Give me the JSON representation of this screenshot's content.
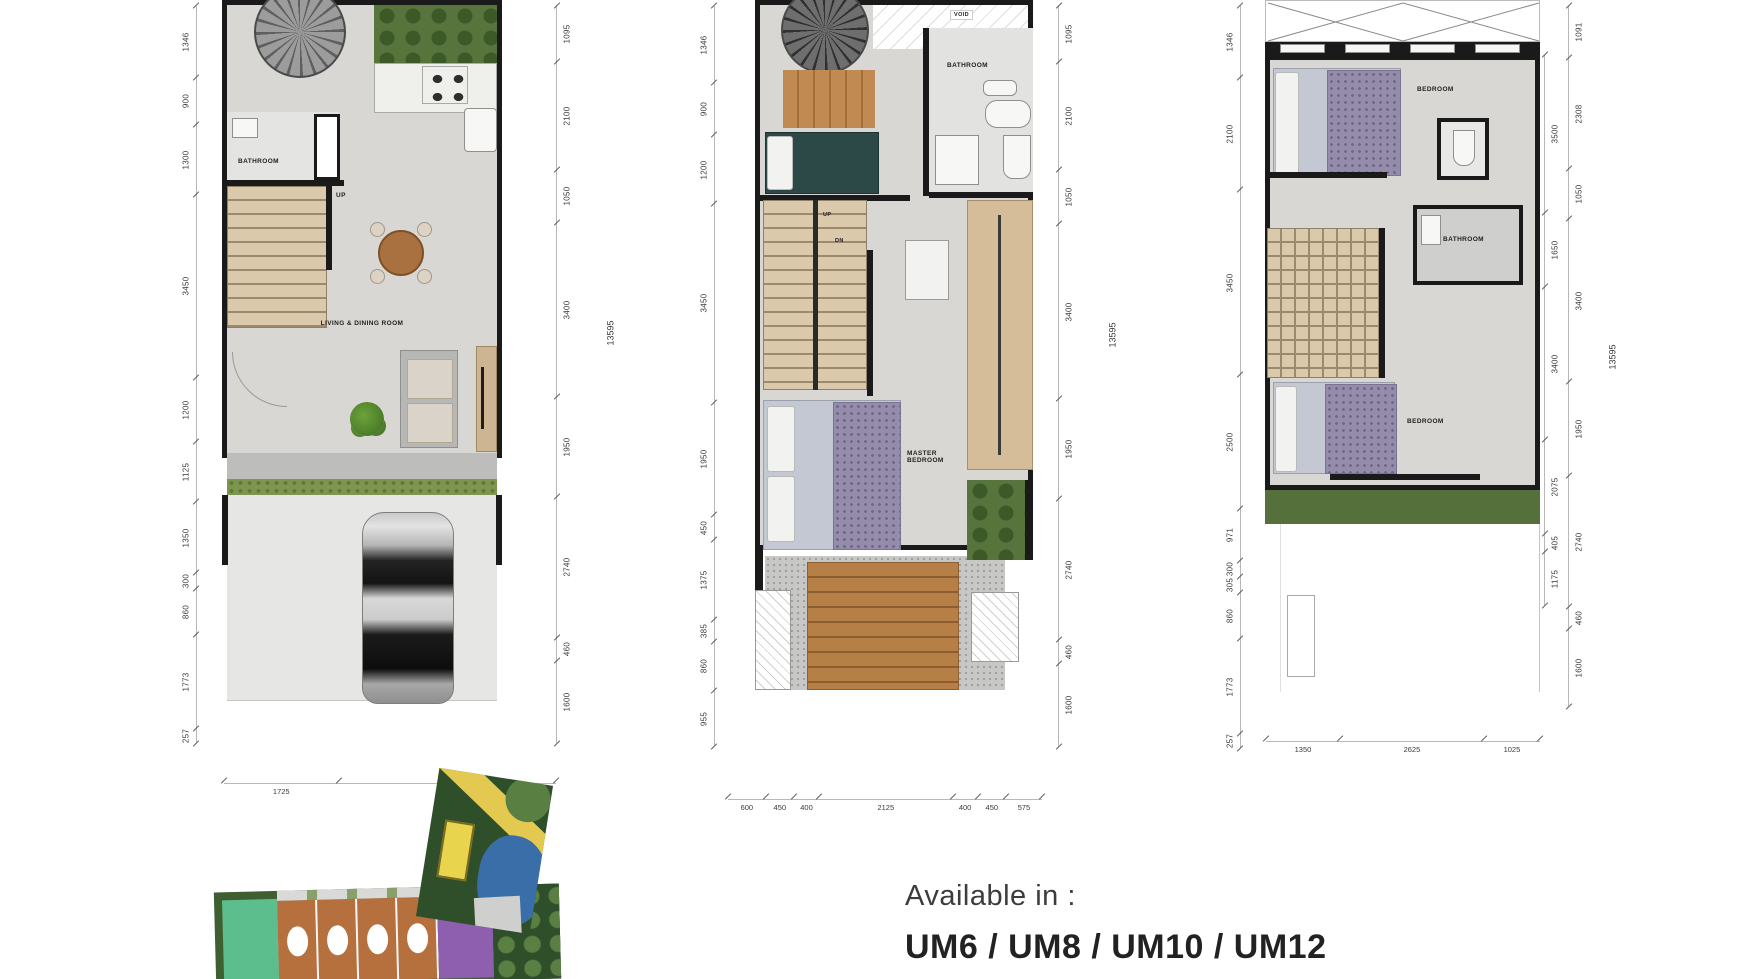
{
  "availability": {
    "label": "Available in :",
    "models": "UM6 / UM8 / UM10 / UM12"
  },
  "plans": [
    {
      "name": "ground-floor",
      "labels": {
        "bathroom": "BATHROOM",
        "up": "UP",
        "living": "LIVING & DINING ROOM"
      },
      "dims_left": [
        "1346",
        "900",
        "1300",
        "3450",
        "1200",
        "1125",
        "1350",
        "300",
        "860",
        "1773",
        "257"
      ],
      "dims_right": [
        "1095",
        "2100",
        "1050",
        "3400",
        "1950",
        "2740",
        "460",
        "1600"
      ],
      "dims_bottom": [
        "1725",
        "3275"
      ],
      "total": "13595"
    },
    {
      "name": "second-floor",
      "labels": {
        "void": "VOID",
        "bathroom": "BATHROOM",
        "up": "UP",
        "dn": "DN",
        "master_line1": "MASTER",
        "master_line2": "BEDROOM"
      },
      "dims_left": [
        "1346",
        "900",
        "1200",
        "3450",
        "1950",
        "450",
        "1375",
        "385",
        "860",
        "955"
      ],
      "dims_right": [
        "1095",
        "2100",
        "1050",
        "3400",
        "1950",
        "2740",
        "460",
        "1600"
      ],
      "dims_bottom": [
        "600",
        "450",
        "400",
        "2125",
        "400",
        "450",
        "575"
      ],
      "total": "13595"
    },
    {
      "name": "third-floor",
      "labels": {
        "bedroom_top": "BEDROOM",
        "bathroom": "BATHROOM",
        "bedroom_bottom": "BEDROOM"
      },
      "dims_left": [
        "1346",
        "2100",
        "3450",
        "2500",
        "971",
        "300",
        "305",
        "860",
        "1773",
        "257"
      ],
      "dims_right_inner": [
        "3500",
        "1650",
        "3400",
        "2075",
        "405",
        "1175"
      ],
      "dims_right": [
        "1091",
        "2308",
        "1050",
        "3400",
        "1950",
        "2740",
        "460",
        "1600"
      ],
      "dims_bottom": [
        "1350",
        "2625",
        "1025"
      ],
      "total": "13595"
    }
  ]
}
